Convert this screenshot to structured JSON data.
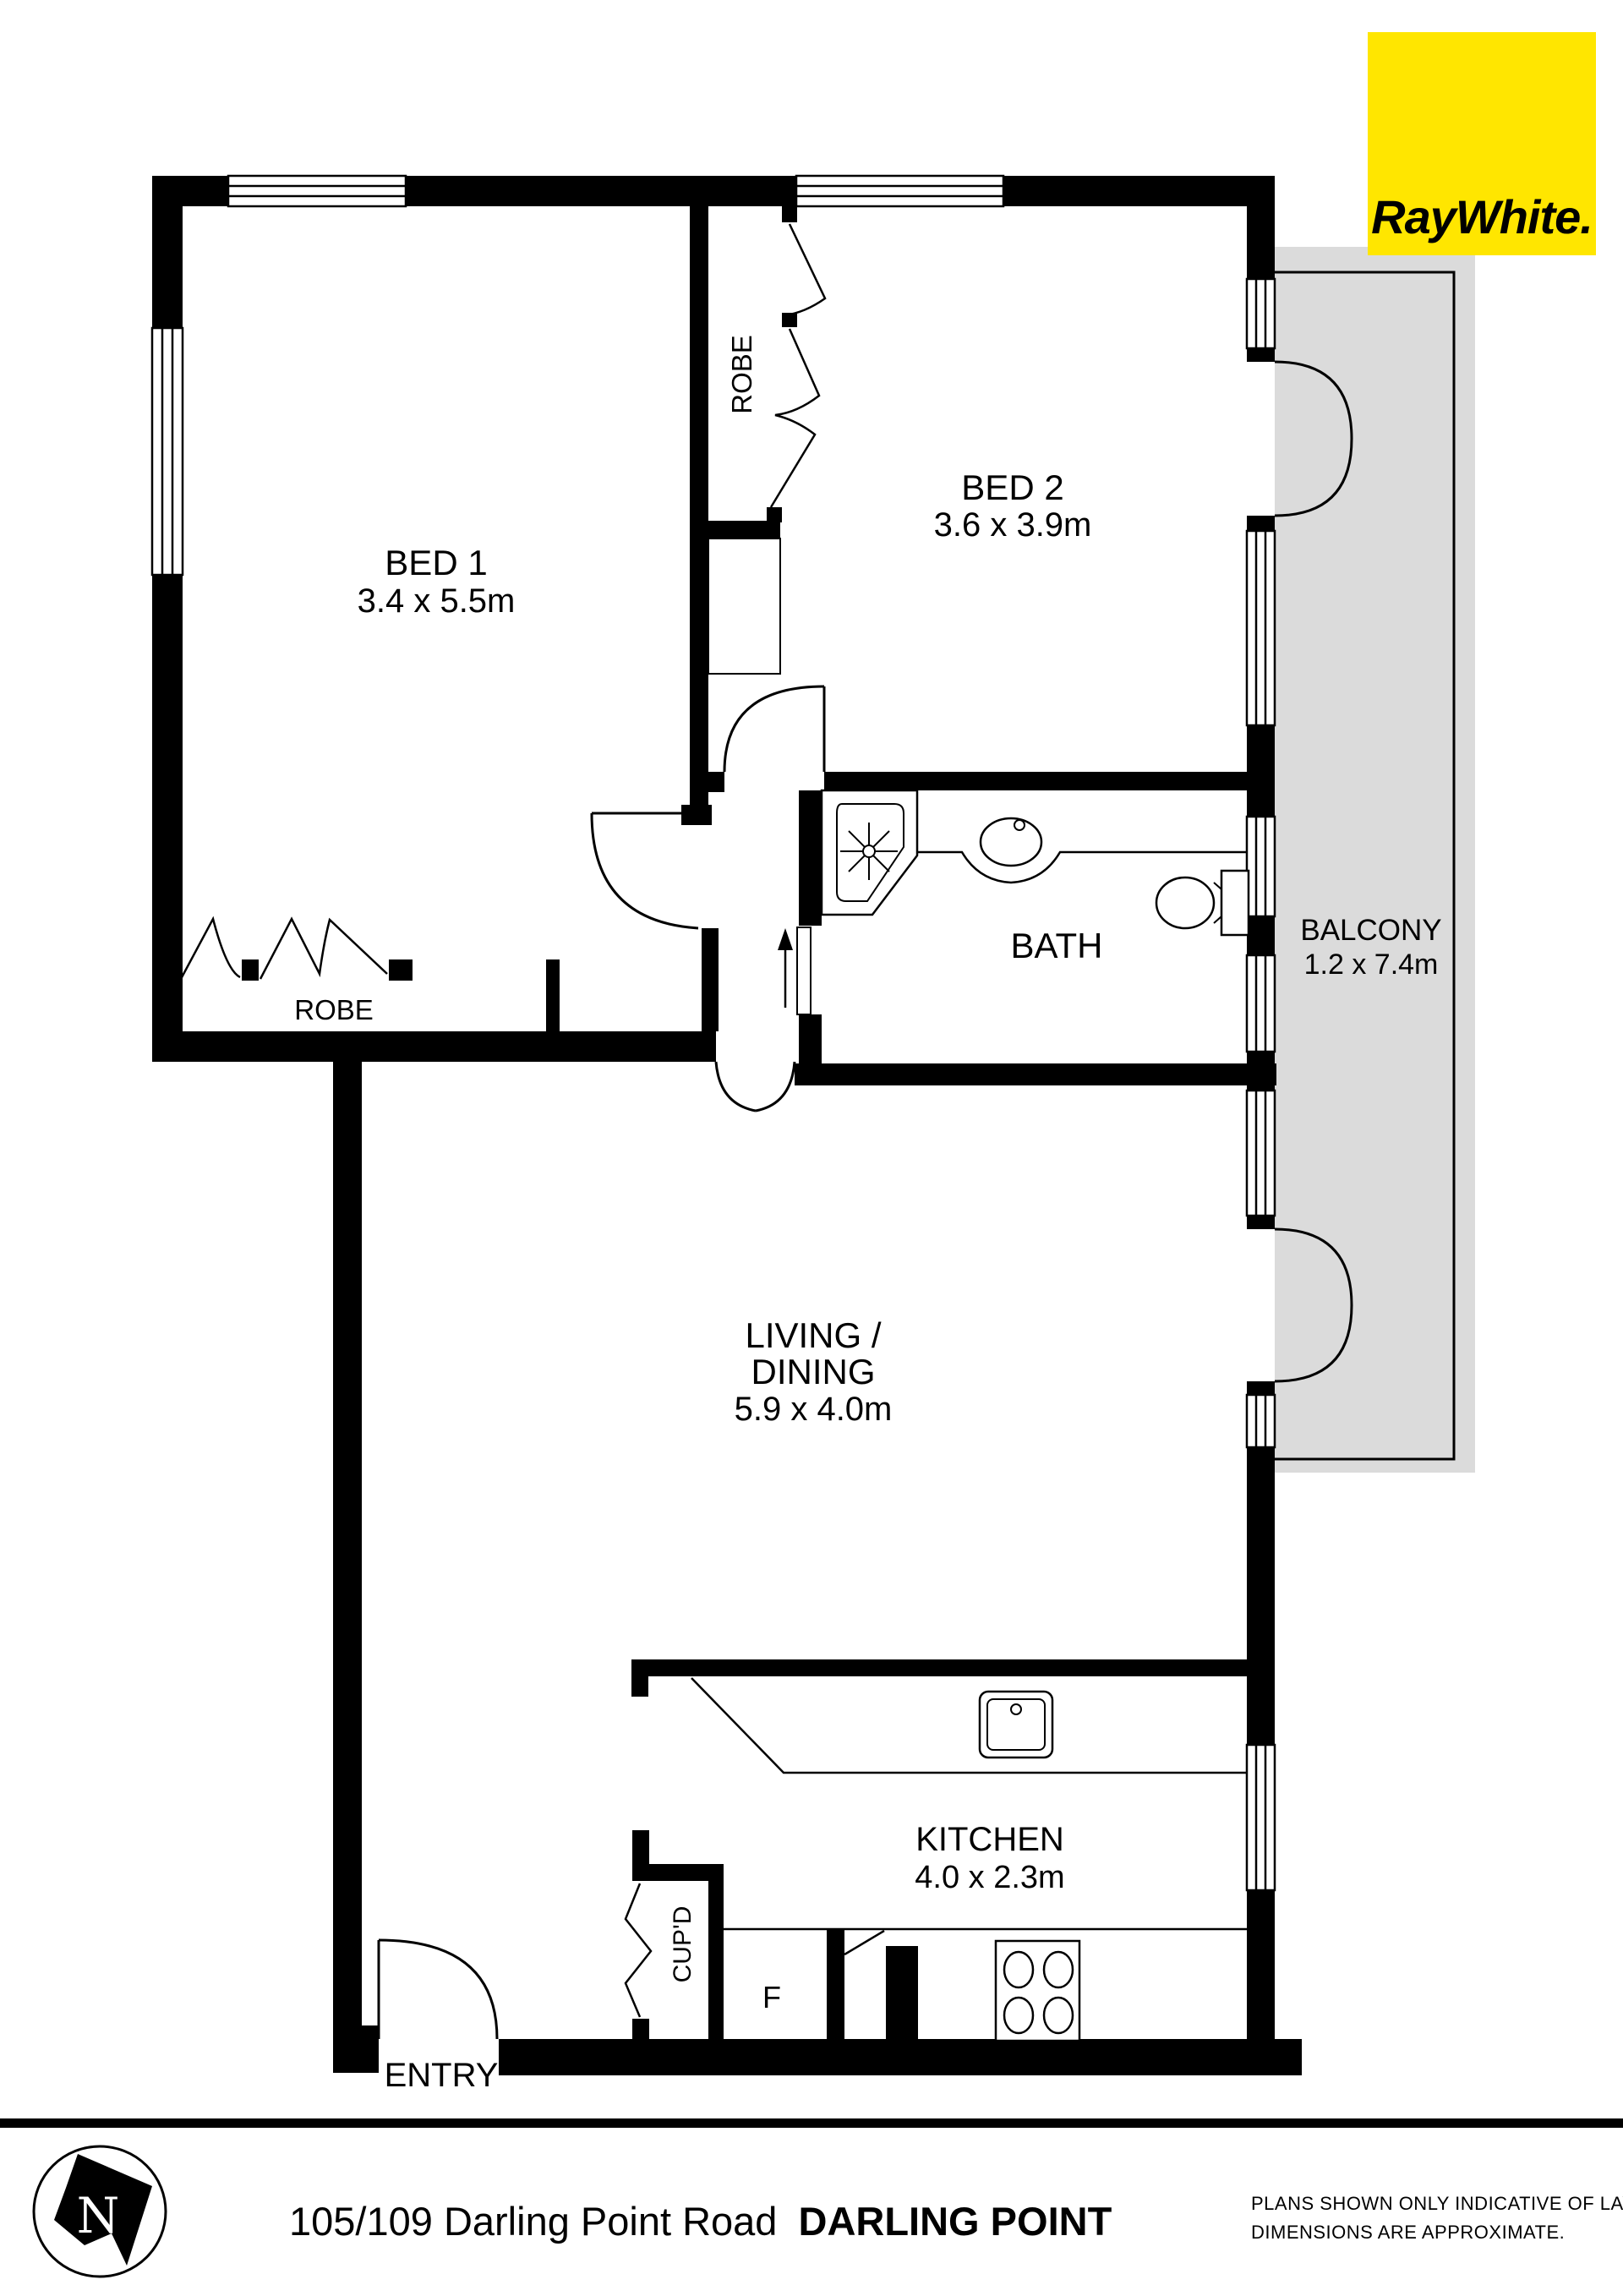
{
  "logo": {
    "brand": "RayWhite."
  },
  "rooms": {
    "bed1": {
      "name": "BED 1",
      "dims": "3.4 x 5.5m"
    },
    "bed2": {
      "name": "BED 2",
      "dims": "3.6 x 3.9m"
    },
    "bath": {
      "name": "BATH"
    },
    "balcony": {
      "name": "BALCONY",
      "dims": "1.2 x 7.4m"
    },
    "living": {
      "name_line1": "LIVING /",
      "name_line2": "DINING",
      "dims": "5.9 x 4.0m"
    },
    "kitchen": {
      "name": "KITCHEN",
      "dims": "4.0 x 2.3m"
    },
    "robe_bed1": {
      "name": "ROBE"
    },
    "robe_bed2": {
      "name": "ROBE"
    },
    "cupboard": {
      "name": "CUP'D"
    },
    "fridge": {
      "name": "F"
    },
    "entry": {
      "name": "ENTRY"
    }
  },
  "compass": {
    "letter": "N"
  },
  "footer": {
    "address_regular": "105/109 Darling Point Road",
    "address_bold": "DARLING POINT",
    "disclaimer_line1": "PLANS SHOWN ONLY INDICATIVE OF LAYOUT.",
    "disclaimer_line2": "DIMENSIONS ARE APPROXIMATE."
  },
  "colors": {
    "wall": "#000000",
    "balcony_fill": "#DBDBDB",
    "logo_bg": "#FFE600",
    "logo_fg": "#54565A"
  }
}
